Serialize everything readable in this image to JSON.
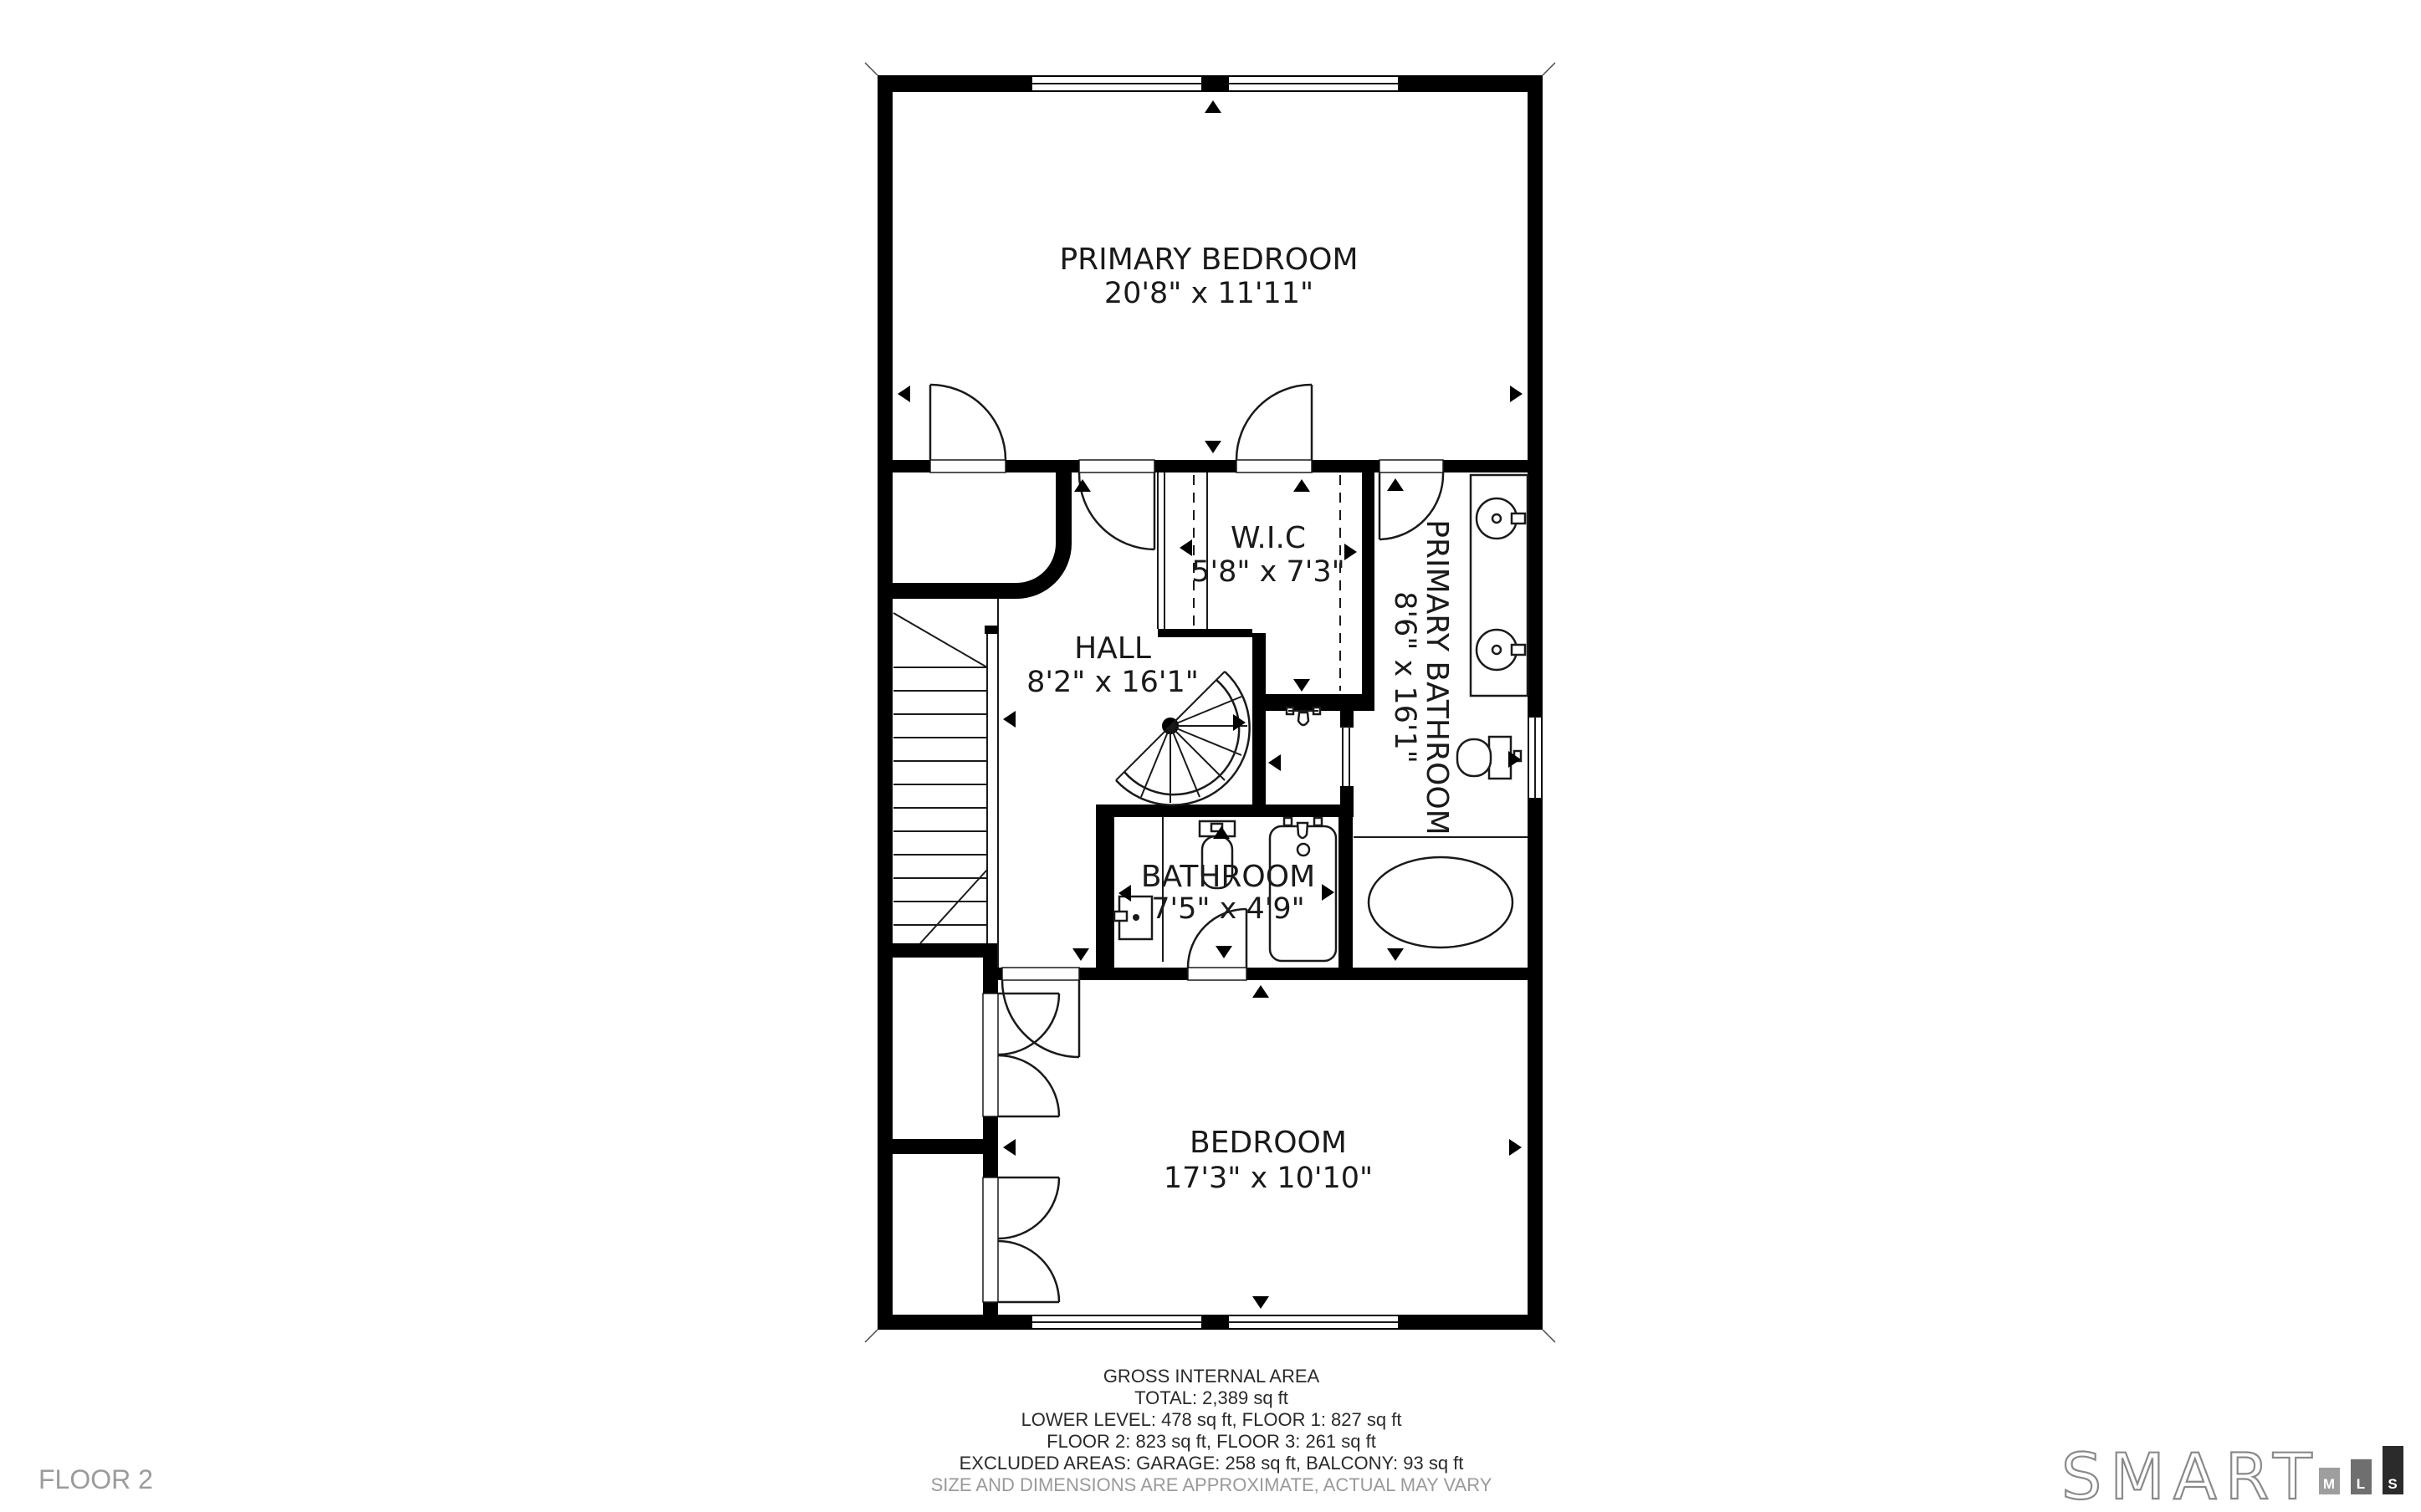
{
  "floor": {
    "label": "FLOOR 2"
  },
  "rooms": [
    {
      "name": "PRIMARY BEDROOM",
      "dims": "20'8\" x 11'11\""
    },
    {
      "name": "W.I.C",
      "dims": "5'8\" x 7'3\""
    },
    {
      "name": "HALL",
      "dims": "8'2\" x 16'1\""
    },
    {
      "name": "PRIMARY BATHROOM",
      "dims": "8'6\" x 16'1\""
    },
    {
      "name": "BATHROOM",
      "dims": "7'5\" x 4'9\""
    },
    {
      "name": "BEDROOM",
      "dims": "17'3\" x 10'10\""
    }
  ],
  "footer": {
    "title": "GROSS INTERNAL AREA",
    "total": "TOTAL: 2,389 sq ft",
    "levels1": "LOWER LEVEL: 478 sq ft, FLOOR 1: 827 sq ft",
    "levels2": "FLOOR 2: 823 sq ft, FLOOR 3: 261 sq ft",
    "excluded": "EXCLUDED AREAS: GARAGE: 258 sq ft, BALCONY: 93 sq ft",
    "disclaimer": "SIZE AND DIMENSIONS ARE APPROXIMATE, ACTUAL MAY VARY"
  },
  "logo": {
    "wordmark": "SMART",
    "bars": [
      {
        "letter": "M",
        "color": "#9e9e9e"
      },
      {
        "letter": "L",
        "color": "#6f6f6f"
      },
      {
        "letter": "S",
        "color": "#2b2b2b"
      }
    ]
  },
  "colors": {
    "wall": "#000000",
    "label": "#1a1a1a",
    "muted": "#9a9a9a",
    "background": "#ffffff"
  }
}
